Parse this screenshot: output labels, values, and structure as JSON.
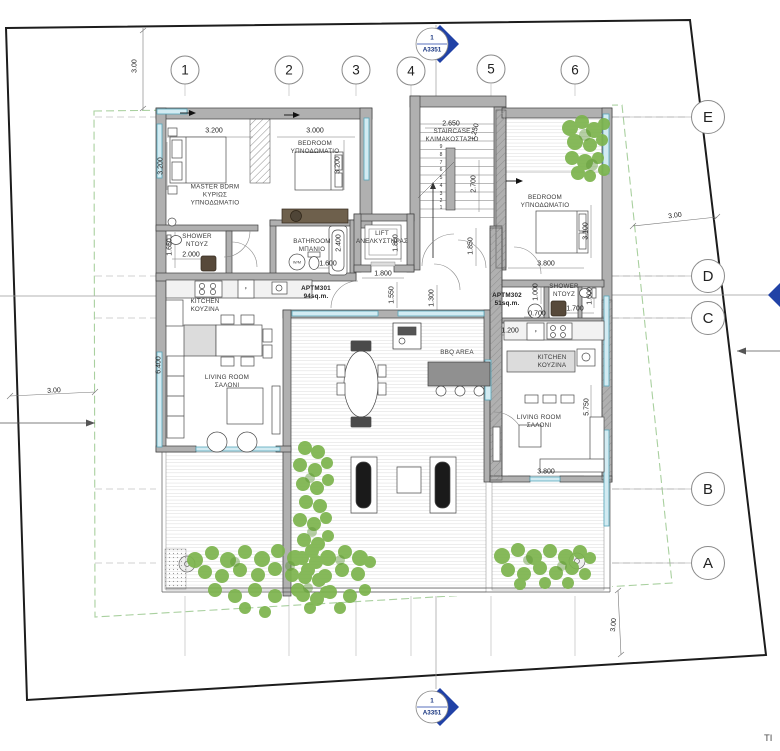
{
  "drawing": {
    "section_marker_number": "1",
    "section_marker_sheet": "A3351",
    "corner_text": "TI"
  },
  "colors": {
    "boundary": "#1c1c1c",
    "setback_dashed": "#a9d09f",
    "wall_fill": "#b0b0b0",
    "glazing": "#58a7bb",
    "plant_green": "#7cb44d",
    "marker_blue": "#2142a6",
    "counter_brown": "#6e604c"
  },
  "grid_columns": [
    {
      "label": "1",
      "x": 185,
      "y": 70
    },
    {
      "label": "2",
      "x": 289,
      "y": 70
    },
    {
      "label": "3",
      "x": 356,
      "y": 70
    },
    {
      "label": "4",
      "x": 411,
      "y": 71
    },
    {
      "label": "5",
      "x": 491,
      "y": 69
    },
    {
      "label": "6",
      "x": 575,
      "y": 70
    }
  ],
  "grid_rows": [
    {
      "label": "E",
      "x": 708,
      "y": 117
    },
    {
      "label": "D",
      "x": 708,
      "y": 276
    },
    {
      "label": "C",
      "x": 708,
      "y": 318
    },
    {
      "label": "B",
      "x": 708,
      "y": 489
    },
    {
      "label": "A",
      "x": 708,
      "y": 563
    }
  ],
  "rooms": [
    {
      "name": "master-bedroom",
      "lines": [
        "MASTER BDRM",
        "ΚΥΡΙΩΣ",
        "ΥΠΝΟΔΩΜΑΤΙΟ"
      ],
      "x": 215,
      "y": 196
    },
    {
      "name": "bedroom-2",
      "lines": [
        "BEDROOM",
        "ΥΠΝΟΔΩΜΑΤΙΟ"
      ],
      "x": 315,
      "y": 148
    },
    {
      "name": "shower-master",
      "lines": [
        "SHOWER",
        "ΝΤΟΥΖ"
      ],
      "x": 197,
      "y": 241
    },
    {
      "name": "bathroom",
      "lines": [
        "BATHROOM",
        "ΜΠΑΝΙΟ"
      ],
      "x": 312,
      "y": 246
    },
    {
      "name": "lift",
      "lines": [
        "LIFT",
        "ΑΝΕΛΚΥΣΤΗΡΑΣ"
      ],
      "x": 382,
      "y": 238
    },
    {
      "name": "staircase",
      "lines": [
        "STAIRCASE",
        "ΚΛΙΜΑΚΟΣΤΑΣΙΟ"
      ],
      "x": 452,
      "y": 136
    },
    {
      "name": "bedroom-3",
      "lines": [
        "BEDROOM",
        "ΥΠΝΟΔΩΜΑΤΙΟ"
      ],
      "x": 545,
      "y": 202
    },
    {
      "name": "shower-2",
      "lines": [
        "SHOWER",
        "ΝΤΟΥΖ"
      ],
      "x": 564,
      "y": 291
    },
    {
      "name": "kitchen-1",
      "lines": [
        "KITCHEN",
        "ΚΟΥΖΙΝΑ"
      ],
      "x": 205,
      "y": 306
    },
    {
      "name": "living-room-1",
      "lines": [
        "LIVING ROOM",
        "ΣΑΛΟΝΙ"
      ],
      "x": 227,
      "y": 382
    },
    {
      "name": "kitchen-2",
      "lines": [
        "KITCHEN",
        "ΚΟΥΖΙΝΑ"
      ],
      "x": 552,
      "y": 362
    },
    {
      "name": "living-room-2",
      "lines": [
        "LIVING ROOM",
        "ΣΑΛΟΝΙ"
      ],
      "x": 539,
      "y": 422
    },
    {
      "name": "bbq-area",
      "lines": [
        "BBQ AREA"
      ],
      "x": 457,
      "y": 353
    },
    {
      "name": "apartment-301",
      "lines": [
        "APTM301",
        "94sq.m."
      ],
      "x": 316,
      "y": 293,
      "bold": true
    },
    {
      "name": "apartment-302",
      "lines": [
        "APTM302",
        "51sq.m."
      ],
      "x": 507,
      "y": 300,
      "bold": true
    },
    {
      "name": "washing-machine-1",
      "lines": [
        "W/M"
      ],
      "x": 297,
      "y": 262,
      "small": true
    },
    {
      "name": "fridge-1",
      "lines": [
        "F"
      ],
      "x": 246,
      "y": 288,
      "small": true
    },
    {
      "name": "fridge-2",
      "lines": [
        "F"
      ],
      "x": 536,
      "y": 331,
      "small": true
    }
  ],
  "dimensions": [
    {
      "t": "3.200",
      "x": 214,
      "y": 131,
      "r": 0
    },
    {
      "t": "3.000",
      "x": 315,
      "y": 131,
      "r": 0
    },
    {
      "t": "3.200",
      "x": 161,
      "y": 166,
      "r": -90
    },
    {
      "t": "3.200",
      "x": 338,
      "y": 165,
      "r": -90
    },
    {
      "t": "2.000",
      "x": 191,
      "y": 255,
      "r": 0
    },
    {
      "t": "1.650",
      "x": 170,
      "y": 247,
      "r": -90
    },
    {
      "t": "1.600",
      "x": 328,
      "y": 264,
      "r": 0
    },
    {
      "t": "2.400",
      "x": 339,
      "y": 243,
      "r": -90
    },
    {
      "t": "2.650",
      "x": 451,
      "y": 124,
      "r": 0
    },
    {
      "t": "1.250",
      "x": 475,
      "y": 132,
      "r": -75
    },
    {
      "t": "2.700",
      "x": 474,
      "y": 184,
      "r": -90
    },
    {
      "t": "1.850",
      "x": 471,
      "y": 246,
      "r": -90
    },
    {
      "t": "1.800",
      "x": 396,
      "y": 243,
      "r": -90
    },
    {
      "t": "1.800",
      "x": 383,
      "y": 274,
      "r": 0
    },
    {
      "t": "1.550",
      "x": 392,
      "y": 295,
      "r": -90
    },
    {
      "t": "1.300",
      "x": 432,
      "y": 298,
      "r": -90
    },
    {
      "t": "3.800",
      "x": 546,
      "y": 264,
      "r": 0
    },
    {
      "t": "3.100",
      "x": 586,
      "y": 231,
      "r": -90
    },
    {
      "t": "1.000",
      "x": 536,
      "y": 292,
      "r": -90
    },
    {
      "t": "1.700",
      "x": 575,
      "y": 309,
      "r": 0
    },
    {
      "t": "0.700",
      "x": 537,
      "y": 314,
      "r": 0
    },
    {
      "t": "1.600",
      "x": 590,
      "y": 296,
      "r": -90
    },
    {
      "t": "1.200",
      "x": 510,
      "y": 331,
      "r": 0
    },
    {
      "t": "6.400",
      "x": 159,
      "y": 365,
      "r": -90
    },
    {
      "t": "5.750",
      "x": 587,
      "y": 407,
      "r": -90
    },
    {
      "t": "3.800",
      "x": 546,
      "y": 472,
      "r": 0
    },
    {
      "t": "3.00",
      "x": 135,
      "y": 66,
      "r": -90
    },
    {
      "t": "3.00",
      "x": 54,
      "y": 391,
      "r": -3
    },
    {
      "t": "3.00",
      "x": 675,
      "y": 216,
      "r": -8
    },
    {
      "t": "3.00",
      "x": 614,
      "y": 625,
      "r": -85
    }
  ],
  "stair_step_numbers": [
    {
      "n": "9",
      "x": 441,
      "y": 147
    },
    {
      "n": "8",
      "x": 441,
      "y": 155
    },
    {
      "n": "7",
      "x": 441,
      "y": 163
    },
    {
      "n": "6",
      "x": 441,
      "y": 170
    },
    {
      "n": "5",
      "x": 441,
      "y": 178
    },
    {
      "n": "4",
      "x": 441,
      "y": 186
    },
    {
      "n": "3",
      "x": 441,
      "y": 194
    },
    {
      "n": "2",
      "x": 441,
      "y": 201
    },
    {
      "n": "1",
      "x": 441,
      "y": 208
    }
  ]
}
